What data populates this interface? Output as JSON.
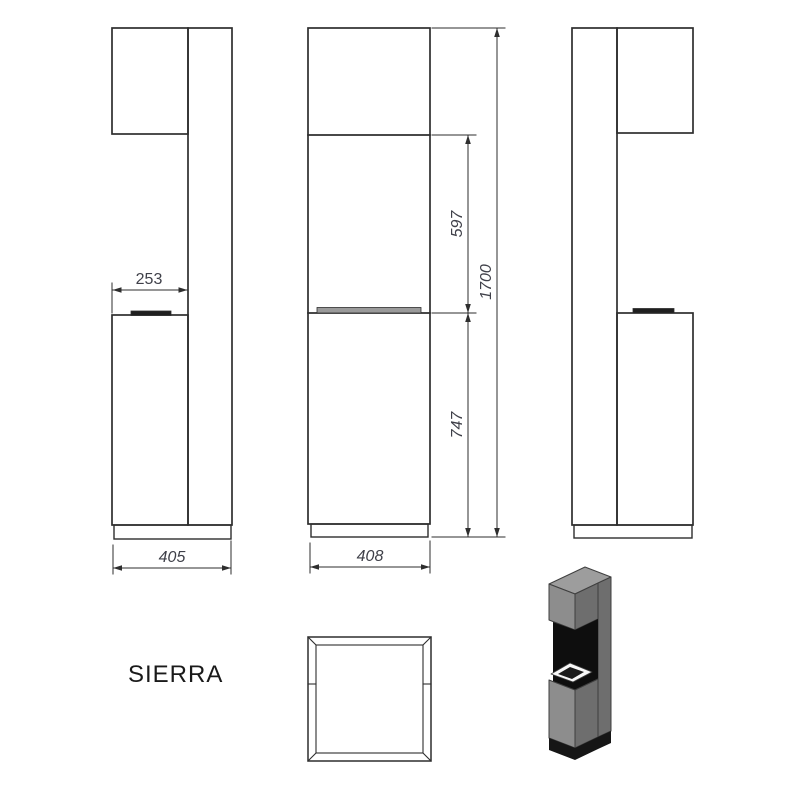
{
  "product": {
    "name": "SIERRA"
  },
  "dimensions": {
    "top_depth": "253",
    "side_total_depth": "405",
    "front_width": "408",
    "firebox_height": "597",
    "cabinet_height": "747",
    "total_height": "1700"
  },
  "colors": {
    "background": "#ffffff",
    "line": "#2e2e2e",
    "dim_text": "#3f4049",
    "product_text": "#1a1a1a",
    "burner_strip": "#1f1f1f",
    "front_band": "#9a9a9a",
    "render_edge": "#3f3f3f",
    "render_top": "#9d9d9d",
    "render_front": "#8d8d8d",
    "render_side": "#6e6e6e",
    "render_recess": "#0e0e0e",
    "render_plinth": "#161616",
    "render_burner": "#f7f7f7",
    "render_slot": "#1c1c1c"
  }
}
